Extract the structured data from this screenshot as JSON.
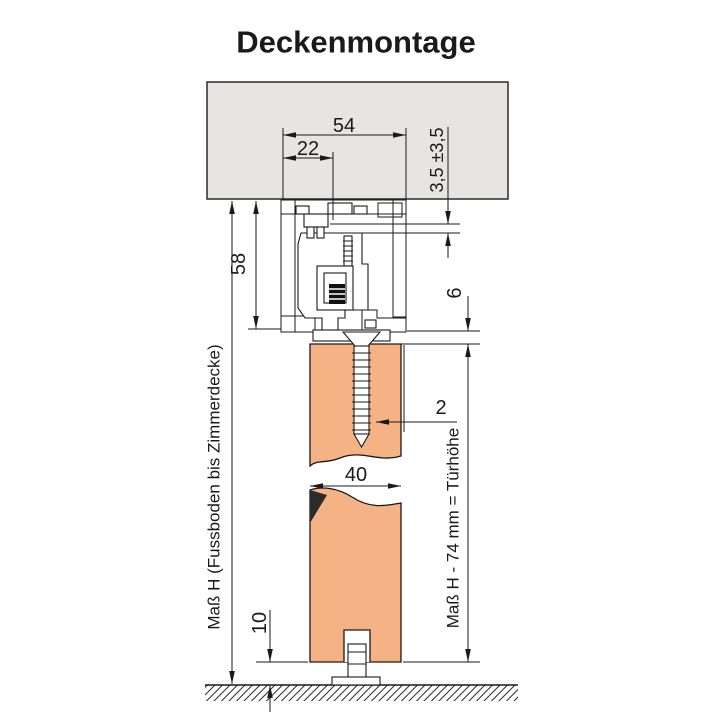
{
  "title": "Deckenmontage",
  "colors": {
    "door": "#f5b284",
    "ceiling": "#e6e5e3",
    "line": "#1a1a1a",
    "title_text": "#4d4d4d"
  },
  "dimensions": {
    "track_width": "54",
    "bolt_offset": "22",
    "height_adjust": "3,5 ±3,5",
    "track_height": "58",
    "gap_track_door": "6",
    "screw_edge": "2",
    "door_thickness": "40",
    "floor_gap": "10"
  },
  "labels": {
    "left_measure": "Maß H (Fussboden bis Zimmerdecke)",
    "right_measure": "Maß H - 74 mm = Türhöhe"
  }
}
